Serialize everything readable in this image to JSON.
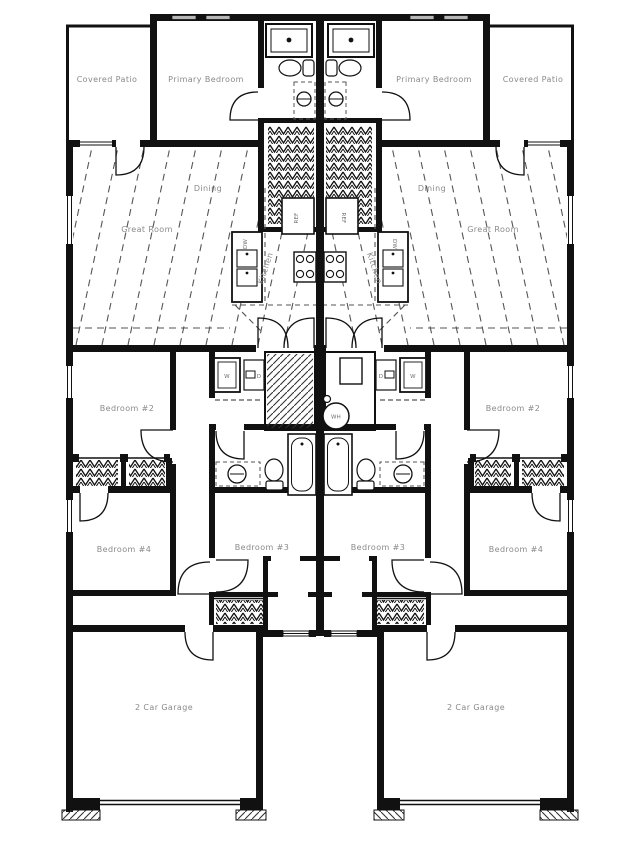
{
  "drawing": {
    "kind": "duplex floor plan, two mirrored units",
    "colors": {
      "wall": "#111111",
      "label_text": "#8a8a8a",
      "background": "#ffffff",
      "window_glass": "#b8b8b8",
      "hatch_line": "#555555"
    }
  },
  "labels": {
    "covered_patio": "Covered Patio",
    "primary_bedroom": "Primary Bedroom",
    "dining": "Dining",
    "great_room": "Great Room",
    "kitchen": "Kitchen",
    "bedroom_2": "Bedroom #2",
    "bedroom_3": "Bedroom #3",
    "bedroom_4": "Bedroom #4",
    "garage": "2 Car Garage",
    "ref": "REF",
    "dw": "DW",
    "washer": "W",
    "dryer": "D",
    "water_heater": "WH"
  }
}
